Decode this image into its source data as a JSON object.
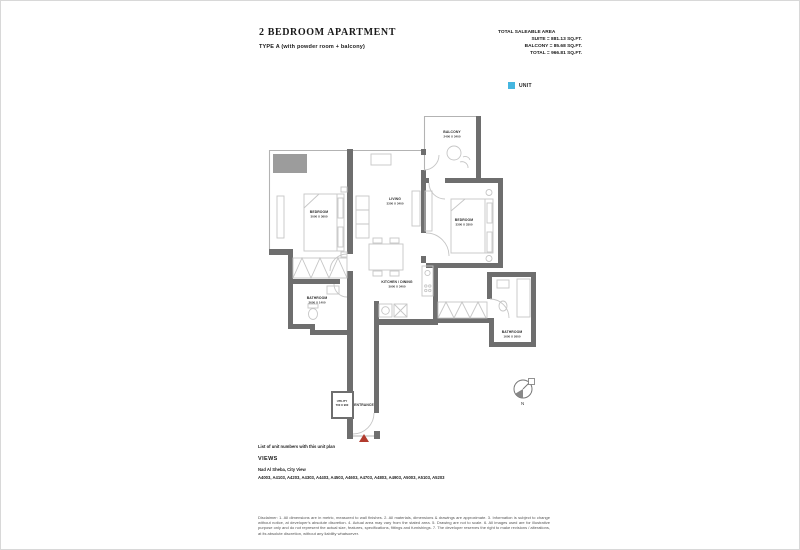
{
  "header": {
    "title": "2 BEDROOM APARTMENT",
    "subtitle": "TYPE A (with powder room + balcony)",
    "area_heading": "TOTAL SALEABLE AREA",
    "area_suite": "SUITE = 881.13 SQ.FT.",
    "area_balcony": "BALCONY = 85.68 SQ.FT.",
    "area_total": "TOTAL = 966.81 SQ.FT.",
    "legend_label": "UNIT",
    "legend_color": "#45b6e0"
  },
  "plan": {
    "wall_color": "#6e6e6e",
    "entrance_marker_color": "#b23b2e",
    "compass_label": "N",
    "rooms": {
      "balcony": {
        "name": "BALCONY",
        "dims": "2400 X 3400"
      },
      "bedroom1": {
        "name": "BEDROOM",
        "dims": "3000 X 3600"
      },
      "living": {
        "name": "LIVING",
        "dims": "3300 X 3400"
      },
      "bedroom2": {
        "name": "BEDROOM",
        "dims": "3300 X 3300"
      },
      "kitchen": {
        "name": "KITCHEN / DINING",
        "dims": "3900 X 3400"
      },
      "bathroom1": {
        "name": "BATHROOM",
        "dims": "2600 X 1400"
      },
      "bathroom2": {
        "name": "BATHROOM",
        "dims": "1600 X 2600"
      },
      "utility": {
        "name": "UTILITY",
        "dims": "700 X 900"
      },
      "entrance": {
        "name": "ENTRANCE"
      }
    }
  },
  "footer": {
    "note": "List of unit numbers with this unit plan",
    "views_heading": "VIEWS",
    "views_line": "Nad Al Sheba, City View",
    "units": "A4003, A4103, A4203, A4303, A4403, A4503, A4603, A4703, A4803, A4903, A5003, A5103, A5203",
    "disclaimer": "Disclaimer: 1. All dimensions are in metric, measured to wall finishes. 2. All materials, dimensions & drawings are approximate. 3. Information is subject to change without notice, at developer's absolute discretion. 4. Actual area may vary from the stated area. 5. Drawing are not to scale. 6. All images used are for illustrative purpose only and do not represent the actual size, features, specifications, fittings and furnishings. 7. The developer reserves the right to make revisions / alterations, at its absolute discretion, without any liability whatsoever."
  }
}
